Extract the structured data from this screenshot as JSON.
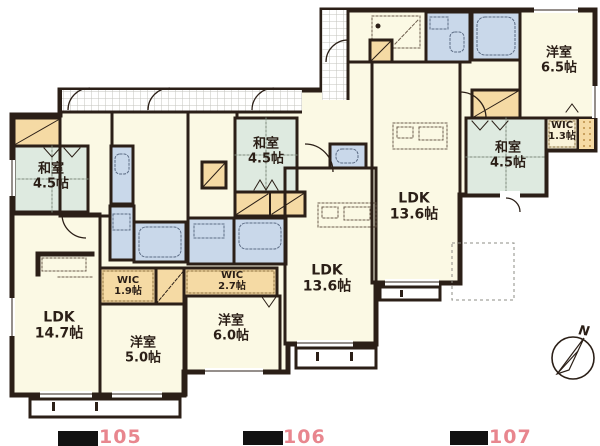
{
  "units": [
    {
      "number": "105",
      "rooms": {
        "washitsu": {
          "name": "和室",
          "size": "4.5帖"
        },
        "ldk": {
          "name": "LDK",
          "size": "14.7帖"
        },
        "wic": {
          "name": "WIC",
          "size": "1.9帖"
        },
        "yoshitsu": {
          "name": "洋室",
          "size": "5.0帖"
        }
      }
    },
    {
      "number": "106",
      "rooms": {
        "washitsu": {
          "name": "和室",
          "size": "4.5帖"
        },
        "wic": {
          "name": "WIC",
          "size": "2.7帖"
        },
        "yoshitsu": {
          "name": "洋室",
          "size": "6.0帖"
        },
        "ldk": {
          "name": "LDK",
          "size": "13.6帖"
        }
      }
    },
    {
      "number": "107",
      "rooms": {
        "yoshitsu": {
          "name": "洋室",
          "size": "6.5帖"
        },
        "wic": {
          "name": "WIC",
          "size": "1.3帖"
        },
        "washitsu": {
          "name": "和室",
          "size": "4.5帖"
        },
        "ldk": {
          "name": "LDK",
          "size": "13.6帖"
        }
      }
    }
  ],
  "compass": {
    "label": "N"
  },
  "colors": {
    "floor": "#FBF9E4",
    "tatami": "#DEEAE0",
    "water": "#C9D8EA",
    "closet": "#F5DAA4",
    "wall": "#2B1F17",
    "unit_number": "#E8868E"
  }
}
